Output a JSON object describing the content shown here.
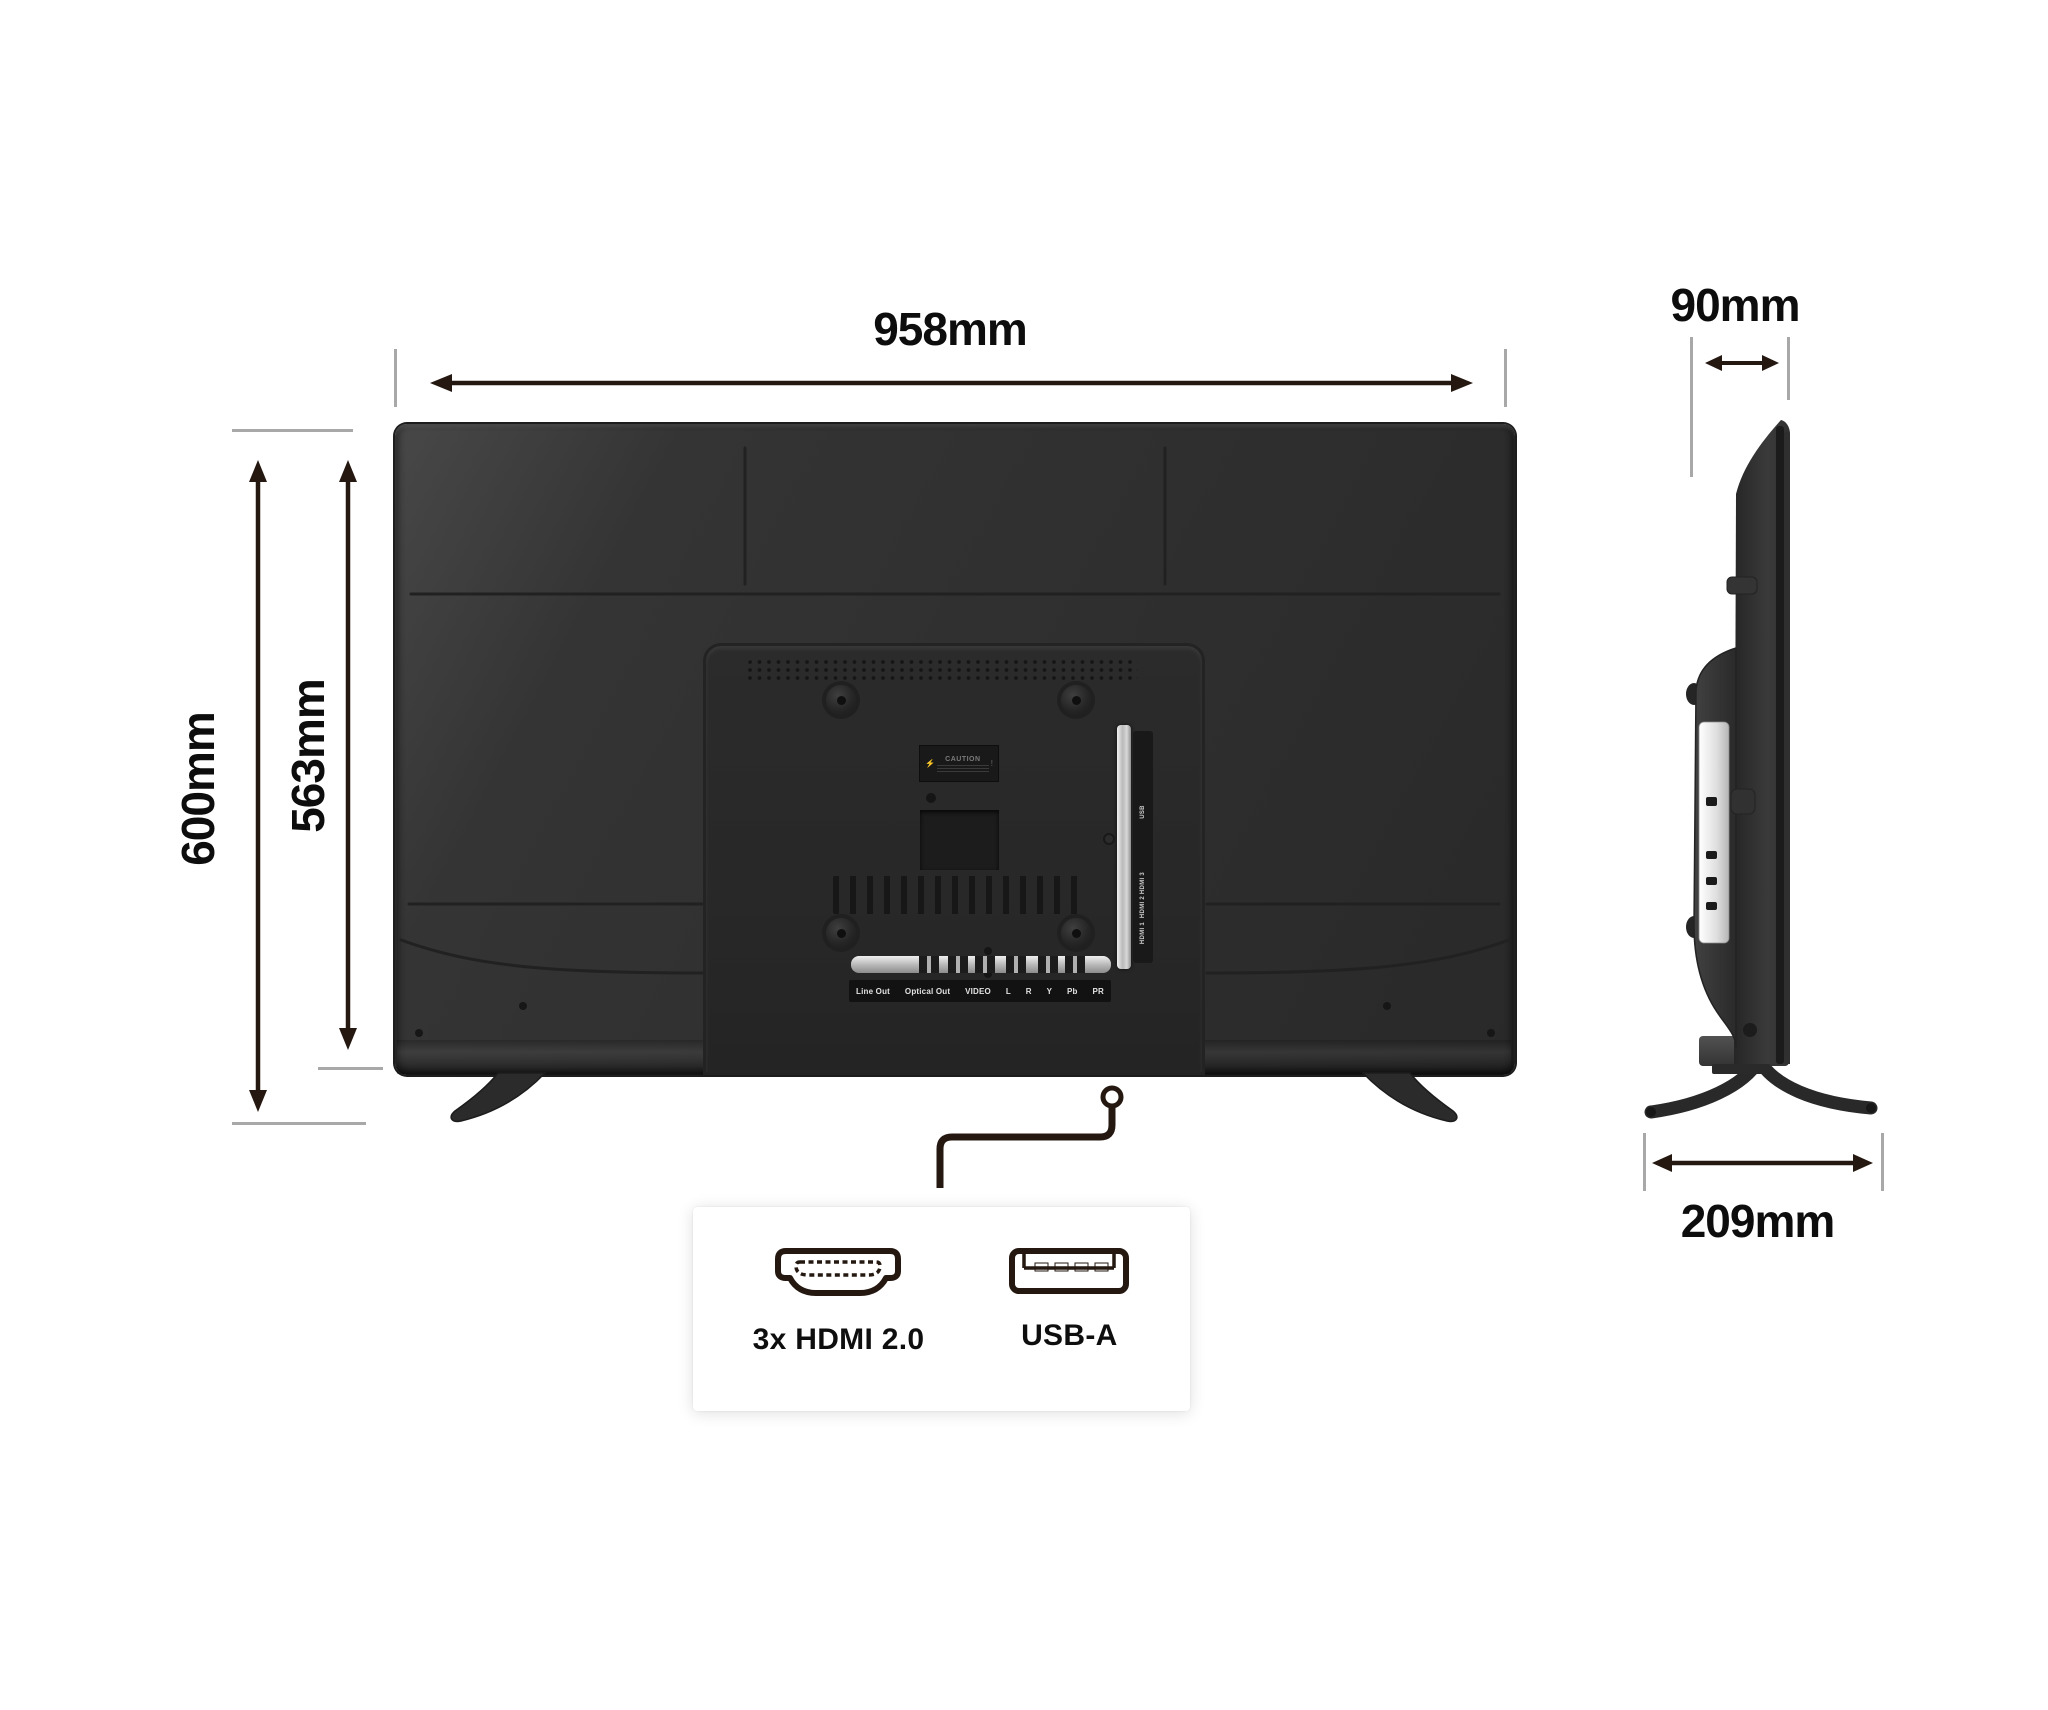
{
  "annotations": {
    "width": "958mm",
    "overall_height": "600mm",
    "panel_height": "563mm",
    "depth": "90mm",
    "stand_depth": "209mm"
  },
  "back_view": {
    "caution_label": "CAUTION",
    "side_port_labels": [
      "USB",
      "HDMI 3",
      "HDMI 2",
      "HDMI 1"
    ],
    "bottom_port_labels": [
      "Line Out",
      "Optical Out",
      "VIDEO",
      "L",
      "R",
      "Y",
      "Pb",
      "PR"
    ]
  },
  "detail_box": {
    "hdmi_label": "3x HDMI 2.0",
    "usb_label": "USB-A"
  },
  "colors": {
    "background": "#ffffff",
    "tv_body": "#303030",
    "dimension_line": "#241811",
    "extension_line": "#a8a8a8",
    "port_metal": "#c9c9c9",
    "detail_box_bg": "#ffffff"
  }
}
